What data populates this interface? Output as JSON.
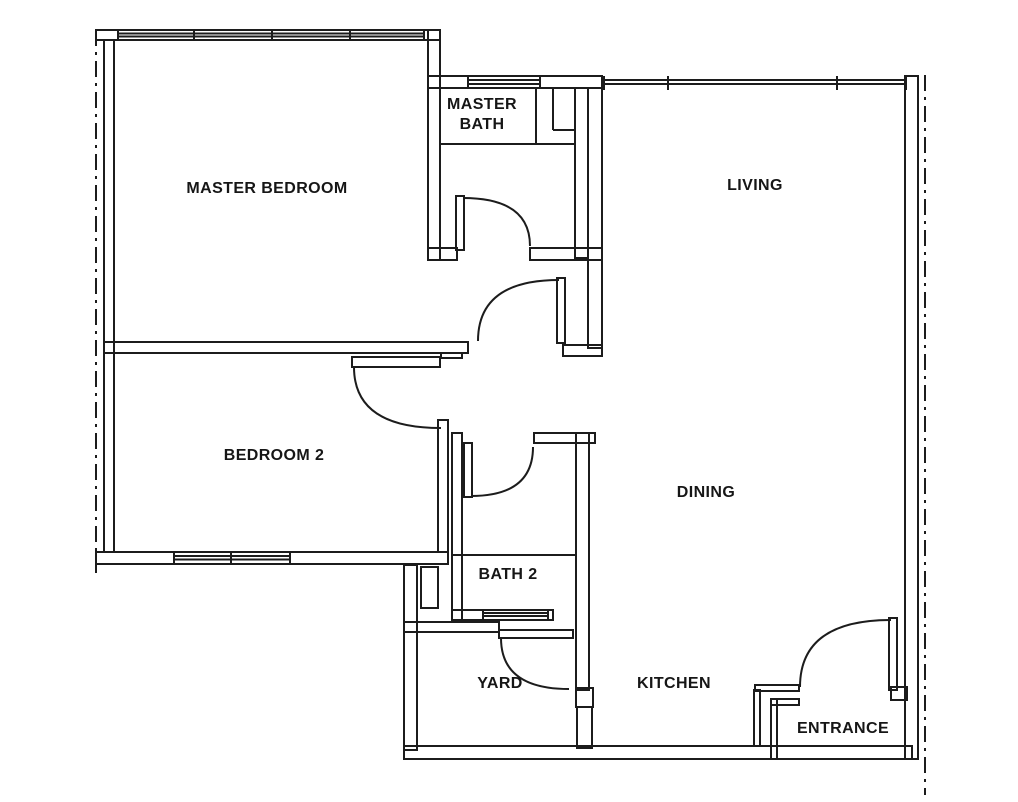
{
  "plan": {
    "type": "apartment-floor-plan",
    "style": "black-and-white scanned blueprint, top-down view",
    "colors": {
      "line": "#1c1c1c",
      "background": "#ffffff"
    }
  },
  "rooms": [
    {
      "id": "master-bedroom",
      "label": "MASTER BEDROOM",
      "lines": [
        "MASTER BEDROOM"
      ],
      "x": 267,
      "y": 189
    },
    {
      "id": "master-bath",
      "label": "MASTER BATH",
      "lines": [
        "MASTER",
        "BATH"
      ],
      "x": 482,
      "y": 115
    },
    {
      "id": "living",
      "label": "LIVING",
      "lines": [
        "LIVING"
      ],
      "x": 755,
      "y": 186
    },
    {
      "id": "bedroom-2",
      "label": "BEDROOM 2",
      "lines": [
        "BEDROOM 2"
      ],
      "x": 274,
      "y": 456
    },
    {
      "id": "dining",
      "label": "DINING",
      "lines": [
        "DINING"
      ],
      "x": 706,
      "y": 493
    },
    {
      "id": "bath-2",
      "label": "BATH 2",
      "lines": [
        "BATH 2"
      ],
      "x": 508,
      "y": 575
    },
    {
      "id": "yard",
      "label": "YARD",
      "lines": [
        "YARD"
      ],
      "x": 500,
      "y": 684
    },
    {
      "id": "kitchen",
      "label": "KITCHEN",
      "lines": [
        "KITCHEN"
      ],
      "x": 674,
      "y": 684
    },
    {
      "id": "entrance",
      "label": "ENTRANCE",
      "lines": [
        "ENTRANCE"
      ],
      "x": 843,
      "y": 729
    }
  ],
  "doors": [
    {
      "room": "master-bath",
      "swing": "quarter-arc"
    },
    {
      "room": "hallway-to-dining",
      "swing": "quarter-arc"
    },
    {
      "room": "bedroom-2",
      "swing": "quarter-arc"
    },
    {
      "room": "bath-2",
      "swing": "quarter-arc"
    },
    {
      "room": "yard",
      "swing": "quarter-arc"
    },
    {
      "room": "entrance",
      "swing": "quarter-arc"
    }
  ],
  "windows": [
    {
      "wall": "master-bedroom-top",
      "panes": 4
    },
    {
      "wall": "master-bath-top",
      "panes": 1
    },
    {
      "wall": "living-top",
      "panes": 3
    },
    {
      "wall": "bedroom-2-bottom",
      "panes": 2
    },
    {
      "wall": "bath-2-bottom",
      "panes": 1
    }
  ],
  "boundaries": [
    {
      "side": "left",
      "style": "dash-dot property line"
    },
    {
      "side": "right",
      "style": "dash-dot property line"
    }
  ]
}
